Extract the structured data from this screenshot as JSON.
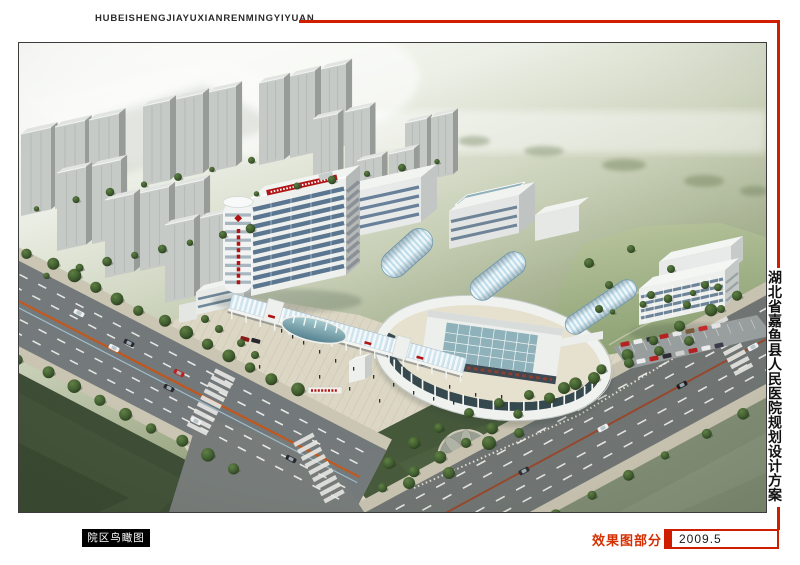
{
  "header": {
    "pinyin_title": "HUBEISHENGJIAYUXIANRENMINGYIYUAN"
  },
  "side": {
    "vertical_title": "湖北省嘉鱼县人民医院规划设计方案"
  },
  "footer": {
    "view_label": "院区鸟瞰图",
    "section_label": "效果图部分",
    "date_label": "2009.5"
  },
  "colors": {
    "accent_red": "#cf1d00",
    "section_label_red": "#d52e00",
    "view_label_bg": "#000000",
    "view_label_text": "#ffffff",
    "page_background": "#ffffff",
    "frame_border": "#3c3c3c",
    "header_text": "#2b2b2b",
    "side_title_text": "#111111",
    "date_text": "#1a1a1a"
  },
  "illustration": {
    "palette": {
      "haze_white": "#fbfcf9",
      "distant_olive": "#7c8a64",
      "city_tower_face": "#c6cac7",
      "city_tower_side": "#989c99",
      "city_tower_roof": "#e2e4e1",
      "hospital_white": "#eef0ee",
      "window_glass_blue": "#5a7690",
      "courtyard_glass_teal": "#8fb2ba",
      "vault_glass_blue": "#bcdcea",
      "colonnade_glass_dark": "#35494f",
      "asphalt_gray": "#73787a",
      "sidewalk_beige": "#cbc5b3",
      "plaza_paving": "#dcd6c4",
      "tree_green_dark": "#2c421f",
      "tree_green_light": "#5a7a40",
      "field_green": "#3b4b33",
      "lawn_green": "#a3b18b",
      "grass_gray_green": "#7e8b72",
      "pool_blue": "#6fa3b0",
      "sign_red": "#b01414",
      "road_line_orange": "#c2571c",
      "road_line_brown": "#96462a",
      "car_red": "#b62222"
    }
  }
}
